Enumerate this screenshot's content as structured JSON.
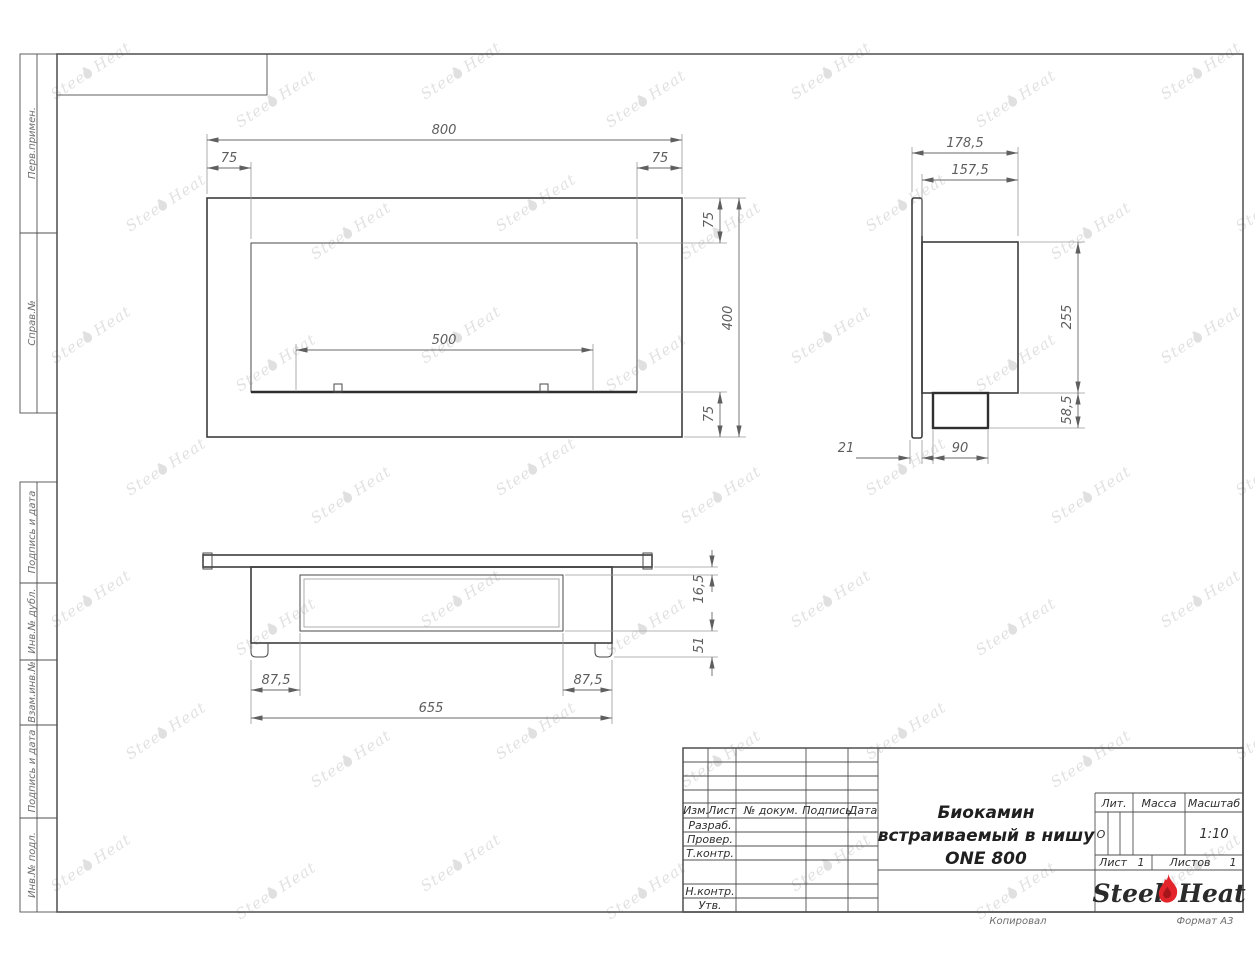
{
  "sheet": {
    "side_columns": [
      "Перв.примен.",
      "Справ.№",
      "Подпись и дата",
      "Инв.№ дубл.",
      "Взам.инв.№",
      "Подпись и дата",
      "Инв.№ подл."
    ],
    "stamp": {
      "rev_header": [
        "Изм.",
        "Лист",
        "№ докум.",
        "Подпись",
        "Дата"
      ],
      "rows": [
        "Разраб.",
        "Провер.",
        "Т.контр.",
        "Н.контр.",
        "Утв."
      ],
      "title_lines": [
        "Биокамин",
        "встраиваемый в нишу",
        "ONE 800"
      ],
      "lit_label": "Лит.",
      "lit_value": "О",
      "mass_label": "Масса",
      "mass_value": "",
      "scale_label": "Масштаб",
      "scale_value": "1:10",
      "sheet_label": "Лист",
      "sheet_value": "1",
      "sheets_label": "Листов",
      "sheets_value": "1",
      "copied": "Копировал",
      "format": "Формат А3"
    },
    "logo": {
      "left": "Steel",
      "right": "Heat",
      "flame_color": "#e3242b",
      "flame_core_color": "#a5161b"
    },
    "watermark": {
      "left": "Steel",
      "right": "Heat"
    }
  },
  "views": {
    "front": {
      "dims": {
        "total_width": "800",
        "left_offset": "75",
        "right_offset": "75",
        "top_offset": "75",
        "total_height": "400",
        "burner_width": "500",
        "bottom_offset": "75"
      }
    },
    "side": {
      "dims": {
        "total_depth": "178,5",
        "inner_depth": "157,5",
        "body_height": "255",
        "tray_height": "58,5",
        "flange_thickness": "21",
        "tray_depth": "90"
      }
    },
    "bottom": {
      "dims": {
        "plate_to_opening": "16,5",
        "opening_to_feet": "51",
        "left_inset": "87,5",
        "right_inset": "87,5",
        "body_width": "655"
      }
    }
  }
}
